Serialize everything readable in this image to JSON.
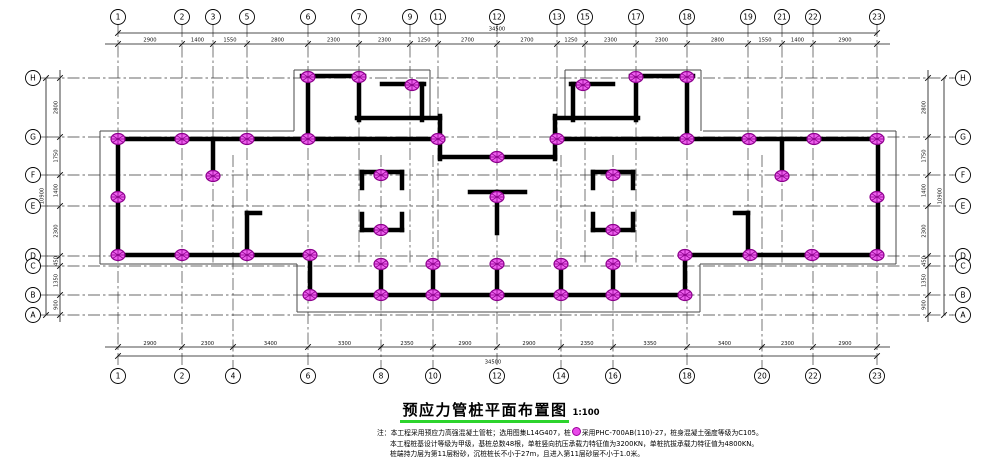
{
  "title": {
    "text": "预应力管桩平面布置图",
    "scale": "1:100"
  },
  "notes": {
    "line1_pre": "注：本工程采用预应力高强混凝土管桩；选用图集L14G407，桩",
    "line1_post": "采用PHC-700AB(110)-27，桩身混凝土强度等级为C105。",
    "line2": "本工程桩基设计等级为甲级，基桩总数48根，单桩竖向抗压承载力特征值为3200KN，单桩抗拔承载力特征值为4800KN。",
    "line3": "桩端持力层为第11层粉砂，沉桩桩长不小于27m，且进入第11层砂层不小于1.0米。"
  },
  "colors": {
    "wall": "#000000",
    "grid": "#3a3a3a",
    "thin": "#4a4a4a",
    "dim": "#111111",
    "pile_fill": "#ee5fee",
    "pile_dark": "#8c008c",
    "title_underline": "#2dd42d"
  },
  "plan": {
    "axes_top": [
      {
        "label": "1",
        "x": 118
      },
      {
        "label": "2",
        "x": 182
      },
      {
        "label": "3",
        "x": 213
      },
      {
        "label": "5",
        "x": 247
      },
      {
        "label": "6",
        "x": 308
      },
      {
        "label": "7",
        "x": 359
      },
      {
        "label": "9",
        "x": 410
      },
      {
        "label": "11",
        "x": 438
      },
      {
        "label": "12",
        "x": 497
      },
      {
        "label": "13",
        "x": 557
      },
      {
        "label": "15",
        "x": 585
      },
      {
        "label": "17",
        "x": 636
      },
      {
        "label": "18",
        "x": 687
      },
      {
        "label": "19",
        "x": 748
      },
      {
        "label": "21",
        "x": 782
      },
      {
        "label": "22",
        "x": 813
      },
      {
        "label": "23",
        "x": 877
      }
    ],
    "axes_bottom": [
      {
        "label": "1",
        "x": 118
      },
      {
        "label": "2",
        "x": 182
      },
      {
        "label": "4",
        "x": 233
      },
      {
        "label": "6",
        "x": 308
      },
      {
        "label": "8",
        "x": 381
      },
      {
        "label": "10",
        "x": 433
      },
      {
        "label": "12",
        "x": 497
      },
      {
        "label": "14",
        "x": 561
      },
      {
        "label": "16",
        "x": 613
      },
      {
        "label": "18",
        "x": 687
      },
      {
        "label": "20",
        "x": 762
      },
      {
        "label": "22",
        "x": 813
      },
      {
        "label": "23",
        "x": 877
      }
    ],
    "axes_side": [
      {
        "label": "H",
        "y": 78
      },
      {
        "label": "G",
        "y": 137
      },
      {
        "label": "F",
        "y": 175
      },
      {
        "label": "E",
        "y": 206
      },
      {
        "label": "D",
        "y": 256
      },
      {
        "label": "C",
        "y": 266
      },
      {
        "label": "B",
        "y": 295
      },
      {
        "label": "A",
        "y": 315
      }
    ],
    "dims": {
      "top_segments": [
        "2900",
        "1400",
        "1550",
        "2800",
        "2300",
        "2300",
        "1250",
        "2700",
        "2700",
        "1250",
        "2300",
        "2300",
        "2800",
        "1550",
        "1400",
        "2900"
      ],
      "bottom_segments": [
        "2900",
        "2300",
        "3400",
        "3300",
        "2350",
        "2900",
        "2900",
        "2350",
        "3350",
        "3400",
        "2300",
        "2900"
      ],
      "left_segments": [
        "2800",
        "1750",
        "1400",
        "2300",
        "450",
        "1350",
        "900"
      ],
      "right_segments": [
        "2800",
        "1750",
        "1400",
        "2300",
        "450",
        "1350",
        "900"
      ],
      "top_total": "34500",
      "bottom_total": "34500",
      "left_total": "10900",
      "right_total": "10900"
    },
    "grid_v": [
      [
        118,
        25,
        370
      ],
      [
        182,
        25,
        370
      ],
      [
        308,
        25,
        370
      ],
      [
        497,
        25,
        370
      ],
      [
        687,
        25,
        370
      ],
      [
        813,
        25,
        370
      ],
      [
        877,
        25,
        370
      ],
      [
        213,
        25,
        265
      ],
      [
        247,
        25,
        265
      ],
      [
        359,
        25,
        265
      ],
      [
        410,
        25,
        265
      ],
      [
        438,
        25,
        265
      ],
      [
        557,
        25,
        265
      ],
      [
        585,
        25,
        265
      ],
      [
        636,
        25,
        265
      ],
      [
        748,
        25,
        265
      ],
      [
        782,
        25,
        265
      ],
      [
        233,
        155,
        370
      ],
      [
        381,
        155,
        370
      ],
      [
        433,
        155,
        370
      ],
      [
        561,
        155,
        370
      ],
      [
        613,
        155,
        370
      ],
      [
        762,
        155,
        370
      ]
    ],
    "grid_h": [
      [
        78,
        47,
        953
      ],
      [
        137,
        47,
        953
      ],
      [
        175,
        47,
        953
      ],
      [
        206,
        47,
        953
      ],
      [
        256,
        47,
        953
      ],
      [
        266,
        47,
        953
      ],
      [
        295,
        47,
        953
      ],
      [
        315,
        47,
        953
      ]
    ],
    "walls": [
      [
        115,
        139,
        443,
        139
      ],
      [
        554,
        139,
        880,
        139
      ],
      [
        118,
        136,
        118,
        258
      ],
      [
        878,
        136,
        878,
        258
      ],
      [
        115,
        255,
        312,
        255
      ],
      [
        683,
        255,
        880,
        255
      ],
      [
        310,
        253,
        310,
        297
      ],
      [
        685,
        253,
        685,
        297
      ],
      [
        308,
        295,
        688,
        295
      ],
      [
        213,
        139,
        213,
        178
      ],
      [
        782,
        139,
        782,
        178
      ],
      [
        247,
        213,
        247,
        255
      ],
      [
        247,
        213,
        260,
        213
      ],
      [
        748,
        213,
        748,
        255
      ],
      [
        735,
        213,
        748,
        213
      ],
      [
        302,
        76,
        364,
        76
      ],
      [
        308,
        76,
        308,
        141
      ],
      [
        359,
        76,
        359,
        120
      ],
      [
        357,
        118,
        440,
        118
      ],
      [
        382,
        84,
        424,
        84
      ],
      [
        422,
        84,
        422,
        120
      ],
      [
        631,
        76,
        693,
        76
      ],
      [
        687,
        76,
        687,
        141
      ],
      [
        636,
        76,
        636,
        120
      ],
      [
        555,
        118,
        638,
        118
      ],
      [
        571,
        84,
        613,
        84
      ],
      [
        573,
        84,
        573,
        120
      ],
      [
        440,
        116,
        440,
        159
      ],
      [
        555,
        116,
        555,
        159
      ],
      [
        440,
        157,
        555,
        157
      ],
      [
        362,
        172,
        402,
        172
      ],
      [
        362,
        230,
        402,
        230
      ],
      [
        362,
        172,
        362,
        188
      ],
      [
        362,
        214,
        362,
        230
      ],
      [
        402,
        172,
        402,
        188
      ],
      [
        402,
        214,
        402,
        230
      ],
      [
        593,
        172,
        633,
        172
      ],
      [
        593,
        230,
        633,
        230
      ],
      [
        593,
        172,
        593,
        188
      ],
      [
        593,
        214,
        593,
        230
      ],
      [
        633,
        172,
        633,
        188
      ],
      [
        633,
        214,
        633,
        230
      ],
      [
        470,
        192,
        525,
        192
      ],
      [
        497,
        192,
        497,
        233
      ],
      [
        381,
        263,
        381,
        297
      ],
      [
        433,
        263,
        433,
        297
      ],
      [
        497,
        263,
        497,
        297
      ],
      [
        561,
        263,
        561,
        297
      ],
      [
        613,
        263,
        613,
        297
      ]
    ],
    "thin_lines": [
      [
        100,
        131,
        294,
        131
      ],
      [
        703,
        131,
        896,
        131
      ],
      [
        100,
        131,
        100,
        264
      ],
      [
        896,
        131,
        896,
        264
      ],
      [
        100,
        264,
        297,
        264
      ],
      [
        700,
        264,
        896,
        264
      ],
      [
        297,
        264,
        297,
        312
      ],
      [
        700,
        264,
        700,
        312
      ],
      [
        297,
        312,
        700,
        312
      ],
      [
        294,
        70,
        430,
        70
      ],
      [
        294,
        70,
        294,
        131
      ],
      [
        430,
        70,
        430,
        118
      ],
      [
        565,
        70,
        701,
        70
      ],
      [
        701,
        70,
        701,
        131
      ],
      [
        565,
        70,
        565,
        118
      ]
    ],
    "piles": [
      [
        308,
        77
      ],
      [
        359,
        77
      ],
      [
        412,
        85
      ],
      [
        583,
        85
      ],
      [
        636,
        77
      ],
      [
        687,
        77
      ],
      [
        118,
        139
      ],
      [
        182,
        139
      ],
      [
        247,
        139
      ],
      [
        308,
        139
      ],
      [
        438,
        139
      ],
      [
        557,
        139
      ],
      [
        687,
        139
      ],
      [
        749,
        139
      ],
      [
        814,
        139
      ],
      [
        877,
        139
      ],
      [
        497,
        157
      ],
      [
        213,
        176
      ],
      [
        782,
        176
      ],
      [
        381,
        175
      ],
      [
        613,
        175
      ],
      [
        381,
        230
      ],
      [
        613,
        230
      ],
      [
        497,
        197
      ],
      [
        118,
        197
      ],
      [
        877,
        197
      ],
      [
        118,
        255
      ],
      [
        182,
        255
      ],
      [
        247,
        255
      ],
      [
        310,
        255
      ],
      [
        685,
        255
      ],
      [
        750,
        255
      ],
      [
        812,
        255
      ],
      [
        877,
        255
      ],
      [
        381,
        264
      ],
      [
        433,
        264
      ],
      [
        497,
        264
      ],
      [
        561,
        264
      ],
      [
        613,
        264
      ],
      [
        310,
        295
      ],
      [
        381,
        295
      ],
      [
        433,
        295
      ],
      [
        497,
        295
      ],
      [
        561,
        295
      ],
      [
        613,
        295
      ],
      [
        685,
        295
      ]
    ]
  }
}
